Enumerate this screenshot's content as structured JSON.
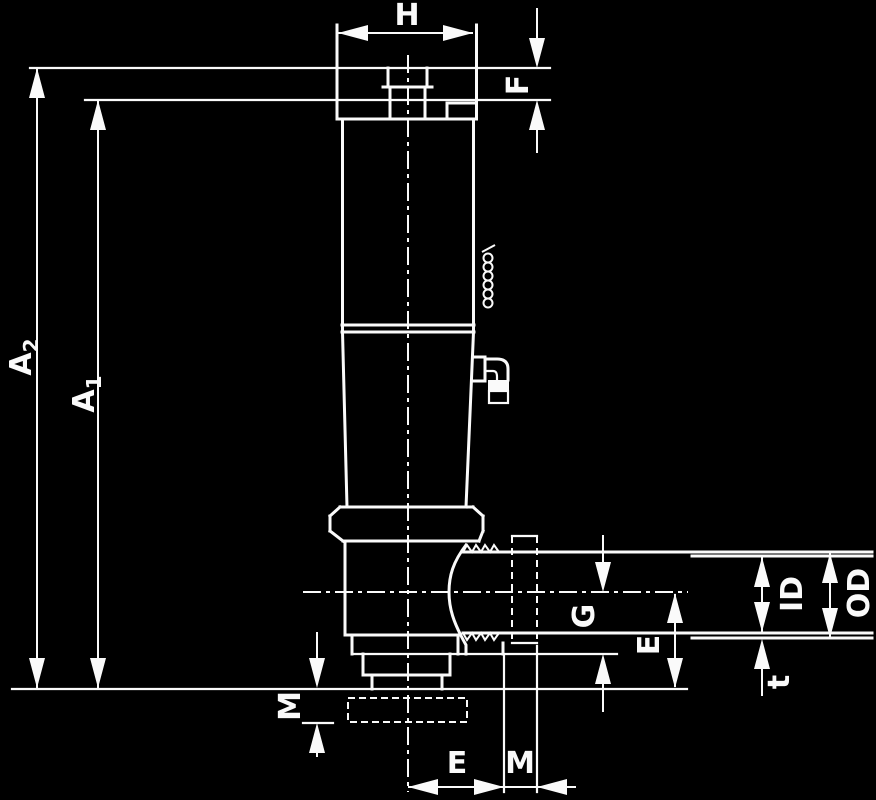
{
  "drawing": {
    "type": "technical-dimension-drawing",
    "colors": {
      "background": "#000000",
      "line": "#fafafa"
    }
  },
  "labels": {
    "h": "H",
    "f": "F",
    "a2": "A",
    "a2_sub": "2",
    "a1": "A",
    "a1_sub": "1",
    "m_left": "M",
    "e_bottom": "E",
    "m_bottom": "M",
    "g": "G",
    "e_right": "E",
    "id": "ID",
    "od": "OD",
    "t": "t"
  }
}
